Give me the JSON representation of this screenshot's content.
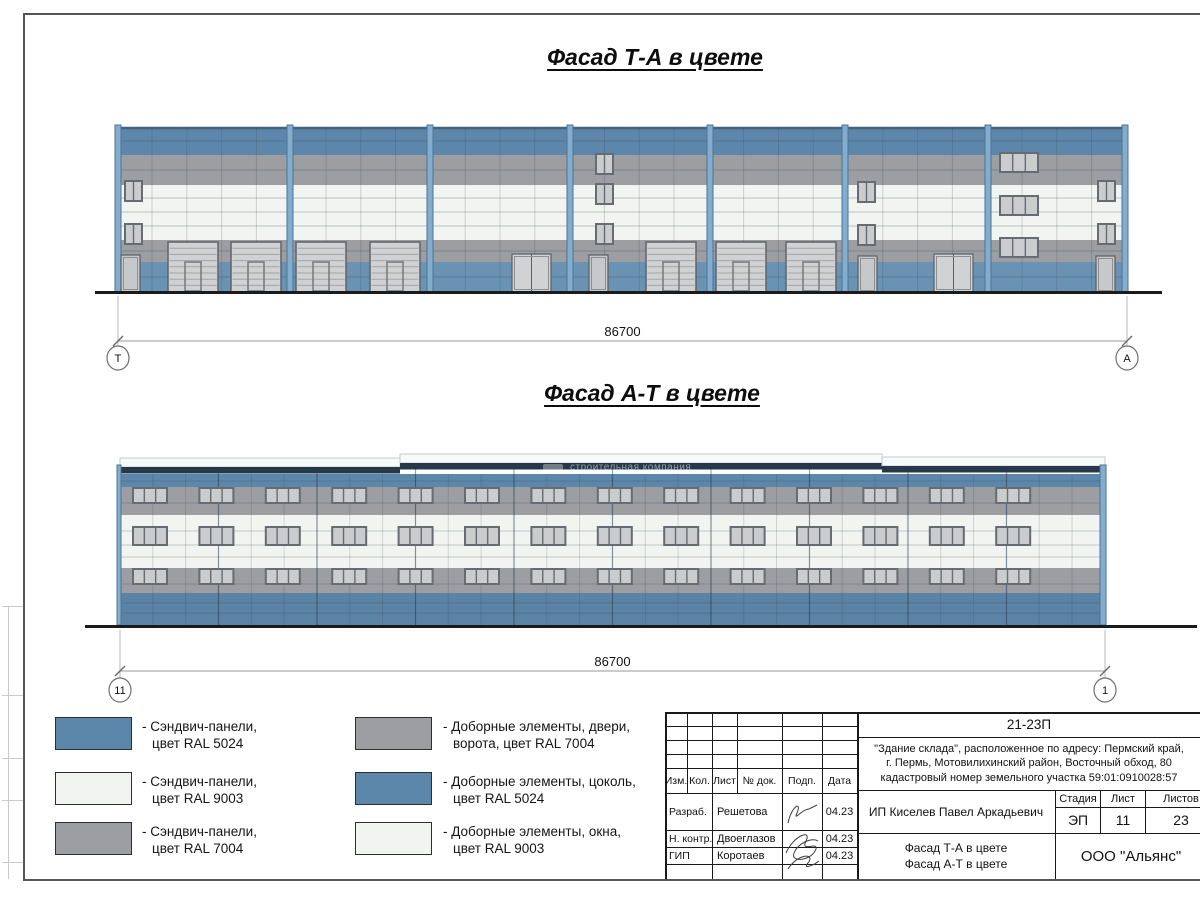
{
  "sheet": {
    "title_top": "Фасад Т-А в цвете",
    "title_bottom": "Фасад А-Т в цвете",
    "watermark": "строительная компания",
    "dimension_top": "86700",
    "dimension_bottom": "86700",
    "axes": {
      "top_left": "Т",
      "top_right": "А",
      "bottom_left": "11",
      "bottom_right": "1"
    }
  },
  "colors": {
    "ral5024": "#5d87aa",
    "ral9003": "#f1f4f1",
    "ral7004": "#9c9ea1",
    "plinth_blue": "#6a93b3",
    "lower_blue": "#5b83a5",
    "pilaster": "#84adcd",
    "pilaster_edge": "#4c7392",
    "navy_parapet": "#273848",
    "window_glass": "#caccce",
    "window_frame": "#666c71",
    "door_fill": "#cfd1d3",
    "door_frame": "#5a5e62",
    "ground": "#1b1b1b"
  },
  "legend": {
    "items": [
      {
        "color": "ral5024",
        "label1": "- Сэндвич-панели,",
        "label2": "цвет RAL 5024"
      },
      {
        "color": "ral9003",
        "label1": "- Сэндвич-панели,",
        "label2": "цвет RAL 9003"
      },
      {
        "color": "ral7004",
        "label1": "- Сэндвич-панели,",
        "label2": "цвет RAL 7004"
      },
      {
        "color": "ral7004",
        "label1": "- Доборные элементы, двери,",
        "label2": "ворота, цвет RAL 7004"
      },
      {
        "color": "ral5024",
        "label1": "- Доборные элементы, цоколь,",
        "label2": "цвет RAL 5024"
      },
      {
        "color": "ral9003",
        "label1": "- Доборные элементы, окна,",
        "label2": "цвет RAL 9003"
      }
    ]
  },
  "stamp": {
    "doc_number": "21-23П",
    "description": "\"Здание склада\", расположенное по адресу: Пермский край,\nг. Пермь, Мотовилихинский район, Восточный обход, 80\nкадастровый номер земельного участка 59:01:0910028:57",
    "header_cols": [
      "Изм.",
      "Кол.",
      "Лист",
      "№ док.",
      "Подп.",
      "Дата"
    ],
    "rows": [
      {
        "role": "Разраб.",
        "name": "Решетова",
        "date": "04.23"
      },
      {
        "role": "Н. контр.",
        "name": "Двоеглазов",
        "date": "04.23"
      },
      {
        "role": "ГИП",
        "name": "Коротаев",
        "date": "04.23"
      }
    ],
    "client": "ИП Киселев Павел Аркадьевич",
    "sheet_title": "Фасад Т-А в цвете\nФасад А-Т в цвете",
    "stage_label": "Стадия",
    "sheet_label": "Лист",
    "sheets_label": "Листов",
    "stage": "ЭП",
    "sheet_no": "11",
    "sheets_total": "23",
    "company": "ООО \"Альянс\""
  }
}
